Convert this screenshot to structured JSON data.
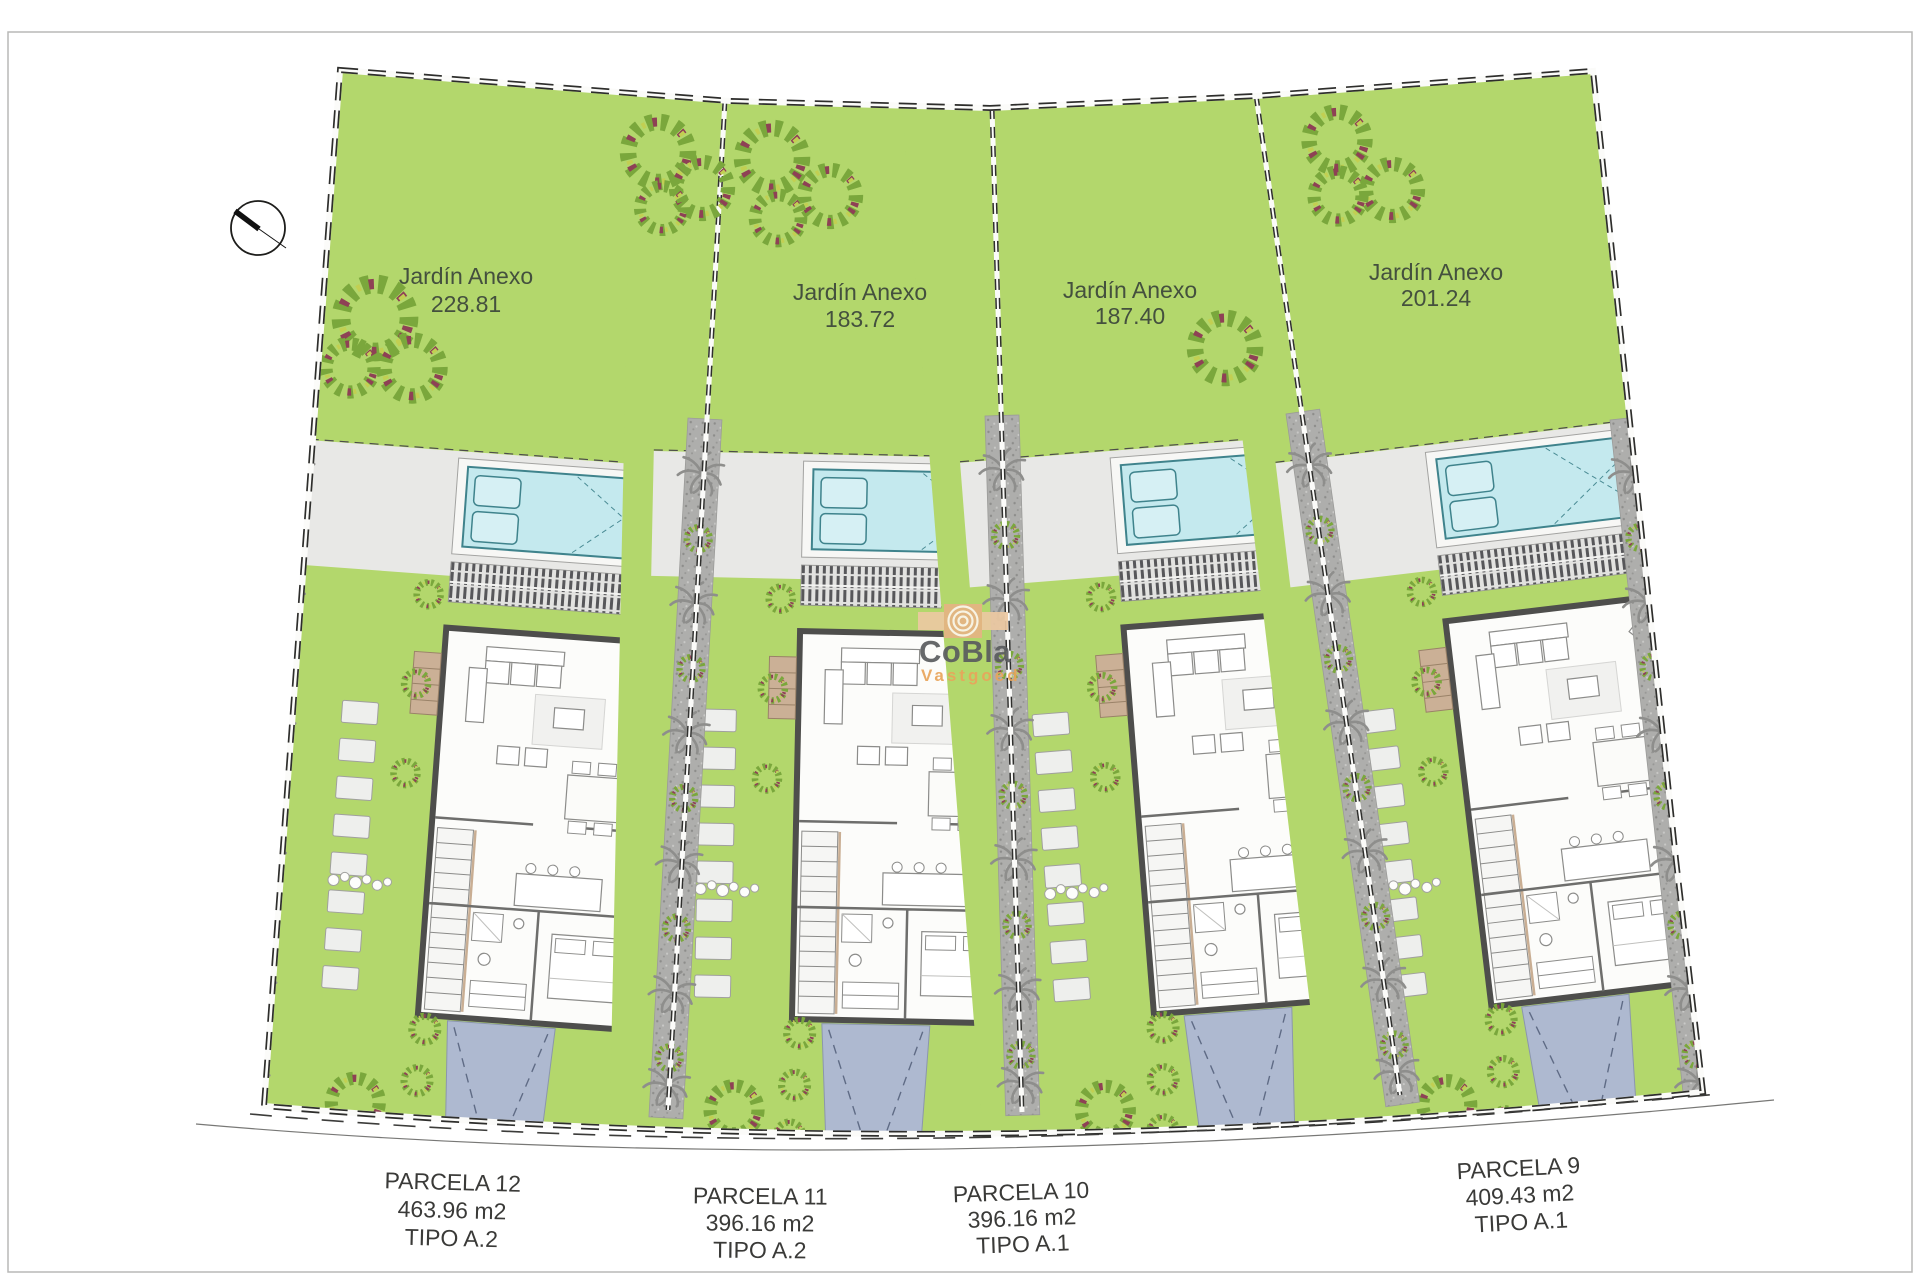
{
  "gardens": [
    {
      "label": "Jardín Anexo",
      "area": "228.81"
    },
    {
      "label": "Jardín Anexo",
      "area": "183.72"
    },
    {
      "label": "Jardín Anexo",
      "area": "187.40"
    },
    {
      "label": "Jardín Anexo",
      "area": "201.24"
    }
  ],
  "parcels": [
    {
      "name": "PARCELA 12",
      "area": "463.96 m2",
      "tipo": "TIPO A.2"
    },
    {
      "name": "PARCELA 11",
      "area": "396.16 m2",
      "tipo": "TIPO A.2"
    },
    {
      "name": "PARCELA 10",
      "area": "396.16 m2",
      "tipo": "TIPO A.1"
    },
    {
      "name": "PARCELA 9",
      "area": "409.43 m2",
      "tipo": "TIPO A.1"
    }
  ],
  "watermark": {
    "brand": "CoBla",
    "sub": "Vastgoed"
  },
  "icons": {
    "compass": "north-arrow-compass"
  },
  "colors": {
    "garden_green": "#b3d76c",
    "pool_water": "#c4e9ee",
    "pool_edge": "#3f838c",
    "driveway": "#aeb9d0",
    "terrace": "#e8e8e6",
    "path_gray": "#aeaeac",
    "house_wall": "#4e4e4c",
    "logo_orange": "#e9a55b",
    "logo_gray": "#5a5c5e"
  }
}
